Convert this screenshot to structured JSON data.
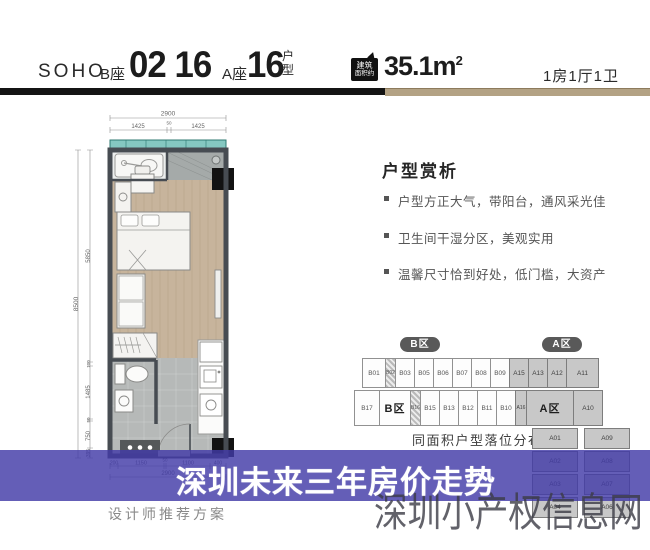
{
  "header": {
    "brand": "SOHO",
    "block_b_label": "B座",
    "block_b_units": "02 16",
    "block_a_label": "A座",
    "block_a_unit": "16",
    "type_char1": "户",
    "type_char2": "型",
    "area_badge_line1": "建筑",
    "area_badge_line2": "面积约",
    "area_value": "35.1m",
    "area_sup": "2",
    "layout_summary": "1房1厅1卫"
  },
  "analysis": {
    "title": "户型赏析",
    "bullets": [
      "户型方正大气，带阳台，通风采光佳",
      "卫生间干湿分区，美观实用",
      "温馨尺寸恰到好处，低门槛，大资产"
    ]
  },
  "floorplan": {
    "caption": "设计师推荐方案",
    "dims": {
      "top_total": "2900",
      "top_a": "1425",
      "top_b": "50",
      "top_c": "1425",
      "left_total": "8500",
      "left_a": "5850",
      "left_b": "100",
      "left_c": "1485",
      "left_d": "50",
      "left_e": "750",
      "left_f": "395",
      "bottom_a": "200",
      "bottom_b": "1150",
      "bottom_c": "50",
      "bottom_d": "1100",
      "bottom_e": "400",
      "bottom_total": "2900"
    }
  },
  "distribution": {
    "zone_b_pill": "B区",
    "zone_a_pill": "A区",
    "row1_b": [
      "B01",
      "B02",
      "B03",
      "B05",
      "B06",
      "B07",
      "B08",
      "B09"
    ],
    "row1_a": [
      "A15",
      "A13",
      "A12",
      "A11"
    ],
    "row2": [
      "B17",
      "B区",
      "B16",
      "B15",
      "B13",
      "B12",
      "B11",
      "B10",
      "A16",
      "A区",
      "A10"
    ],
    "col_left": [
      "A01",
      "A02",
      "A03",
      "A04"
    ],
    "col_right": [
      "A09",
      "A08",
      "A07",
      "A06"
    ],
    "caption": "同面积户型落位分布图"
  },
  "banner": {
    "title": "深圳未来三年房价走势",
    "bg": "#4a42ab"
  },
  "watermark": {
    "text": "深圳小产权信息网"
  },
  "colors": {
    "divider_tan": "#b3a284",
    "banner_indigo": "#4a42ab",
    "wall": "#474c52",
    "wood": "#c7b49c"
  }
}
